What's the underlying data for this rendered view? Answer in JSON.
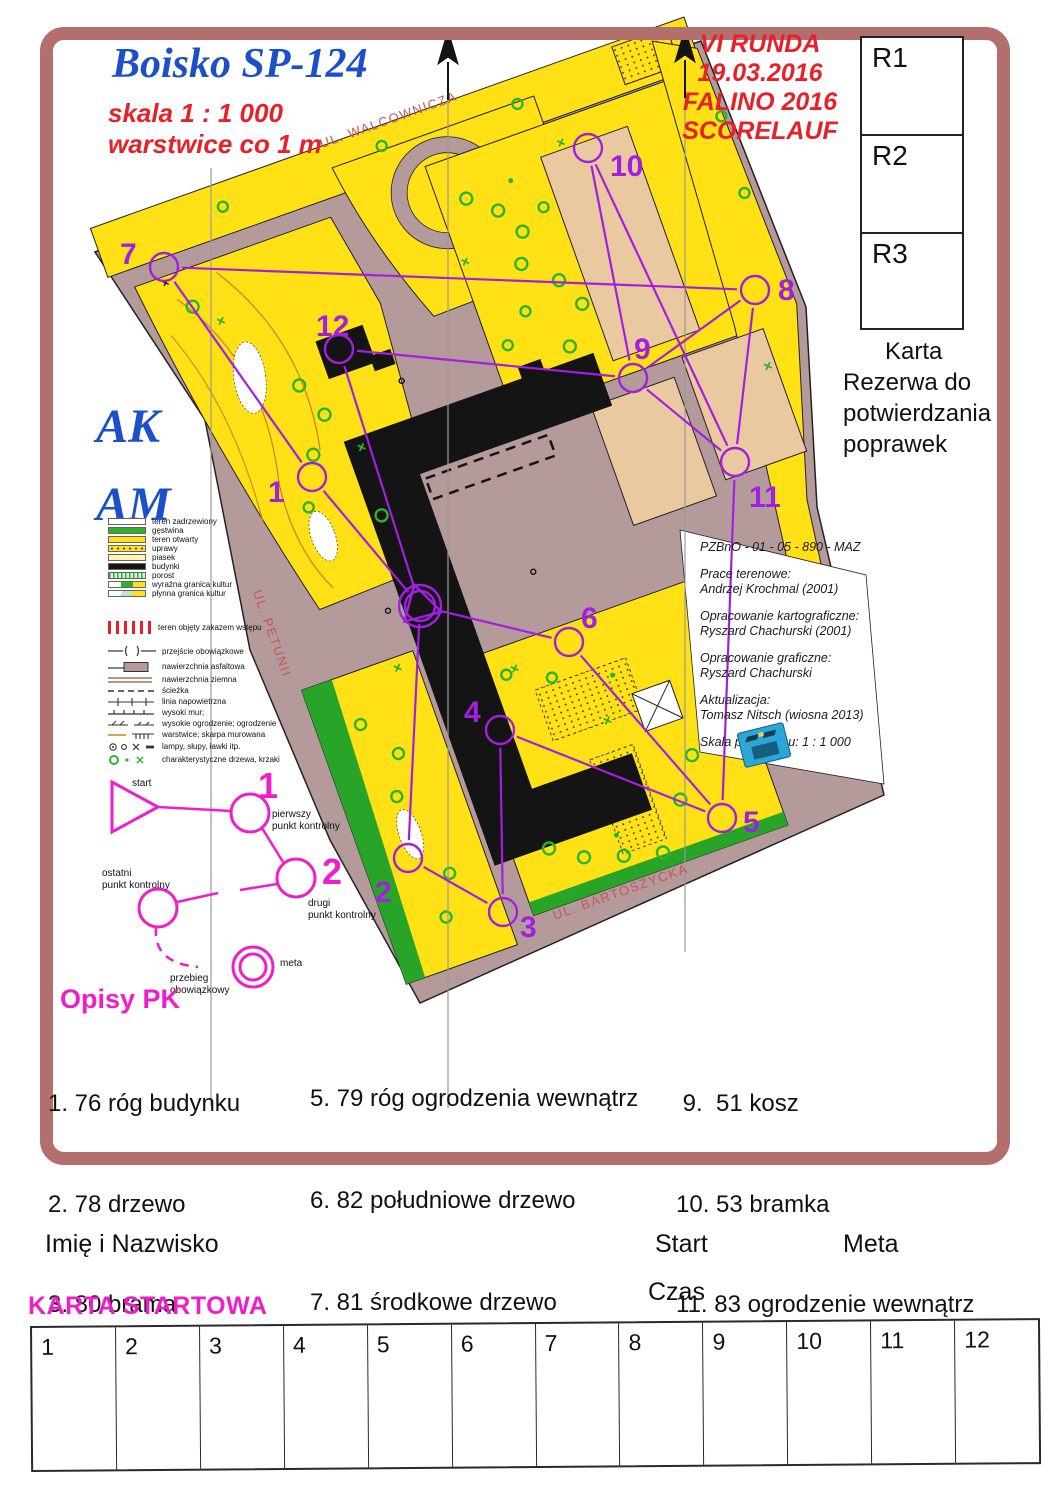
{
  "page": {
    "title": "Boisko SP-124",
    "scale_line1": "skala 1 : 1 000",
    "scale_line2": "warstwice co 1 m"
  },
  "event": {
    "lines": [
      "VI RUNDA",
      "19.03.2016",
      "FALINO 2016",
      "SCORELAUF"
    ]
  },
  "reserve_boxes": [
    "R1",
    "R2",
    "R3"
  ],
  "reserve_note": {
    "lines": [
      "Karta",
      "Rezerwa do",
      "potwierdzania",
      "poprawek"
    ]
  },
  "class_labels": [
    "AK",
    "AM"
  ],
  "legend": {
    "area_items": [
      "teren zadrzewiony",
      "gęstwina",
      "teren otwarty",
      "uprawy",
      "piasek",
      "budynki",
      "porost",
      "wyraźna granica kultur",
      "płynna granica kultur"
    ],
    "forbidden_label": "teren objęty zakazem wstępu",
    "line_items": [
      "przejście obowiązkowe",
      "nawierzchnia asfaltowa",
      "nawierzchnia ziemna",
      "ścieżka",
      "linia napowietrzna",
      "wysoki mur;",
      "wysokie ogrodzenie; ogrodzenie",
      "warstwice; skarpa murowana",
      "lampy, słupy, ławki itp.",
      "charakterystyczne drzewa, krzaki"
    ]
  },
  "course_diagram": {
    "start_label": "start",
    "num1": "1",
    "num2": "2",
    "first": [
      "pierwszy",
      "punkt kontrolny"
    ],
    "second": [
      "drugi",
      "punkt kontrolny"
    ],
    "last": [
      "ostatni",
      "punkt kontrolny"
    ],
    "route": [
      "przebieg",
      "obowiązkowy"
    ],
    "finish_label": "meta"
  },
  "credits": {
    "id_line": "PZBnO - 01 - 05 - 890 - MAZ",
    "groups": [
      {
        "l1": "Prace terenowe:",
        "l2": "Andrzej Krochmal (2001)"
      },
      {
        "l1": "Opracowanie kartograficzne:",
        "l2": "Ryszard Chachurski (2001)"
      },
      {
        "l1": "Opracowanie graficzne:",
        "l2": "Ryszard Chachurski"
      },
      {
        "l1": "Aktualizacja:",
        "l2": "Tomasz Nitsch (wiosna 2013)"
      }
    ],
    "scale_line": "Skala pierworysu: 1 : 1 000"
  },
  "map": {
    "streets": [
      {
        "name": "UL. WALCOWNICZA",
        "x": 390,
        "y": 124,
        "angle": -19.6
      },
      {
        "name": "UL. PETUNII",
        "x": 268,
        "y": 600,
        "angle": 70.5
      },
      {
        "name": "UL. BARTOSZYCKA",
        "x": 622,
        "y": 896,
        "angle": -19.6
      }
    ],
    "controls": [
      {
        "n": "1",
        "x": 312,
        "y": 477,
        "lx": 268,
        "ly": 502
      },
      {
        "n": "2",
        "x": 408,
        "y": 858,
        "lx": 375,
        "ly": 902
      },
      {
        "n": "3",
        "x": 503,
        "y": 912,
        "lx": 520,
        "ly": 937
      },
      {
        "n": "4",
        "x": 500,
        "y": 730,
        "lx": 464,
        "ly": 722
      },
      {
        "n": "5",
        "x": 722,
        "y": 818,
        "lx": 743,
        "ly": 832
      },
      {
        "n": "6",
        "x": 569,
        "y": 642,
        "lx": 581,
        "ly": 628
      },
      {
        "n": "7",
        "x": 164,
        "y": 267,
        "lx": 120,
        "ly": 264
      },
      {
        "n": "8",
        "x": 755,
        "y": 290,
        "lx": 778,
        "ly": 300
      },
      {
        "n": "9",
        "x": 633,
        "y": 378,
        "lx": 634,
        "ly": 359
      },
      {
        "n": "10",
        "x": 588,
        "y": 148,
        "lx": 610,
        "ly": 176
      },
      {
        "n": "11",
        "x": 735,
        "y": 462,
        "lx": 749,
        "ly": 507
      },
      {
        "n": "12",
        "x": 339,
        "y": 349,
        "lx": 316,
        "ly": 336
      }
    ],
    "start": {
      "x": 420,
      "y": 606
    },
    "lines": [
      [
        "7",
        "8"
      ],
      [
        "7",
        "1"
      ],
      [
        "1",
        "S"
      ],
      [
        "12",
        "S"
      ],
      [
        "12",
        "9"
      ],
      [
        "10",
        "9"
      ],
      [
        "10",
        "11"
      ],
      [
        "8",
        "9"
      ],
      [
        "8",
        "11"
      ],
      [
        "9",
        "11"
      ],
      [
        "11",
        "5"
      ],
      [
        "S",
        "6"
      ],
      [
        "6",
        "5"
      ],
      [
        "5",
        "4"
      ],
      [
        "4",
        "3"
      ],
      [
        "3",
        "2"
      ],
      [
        "2",
        "S"
      ]
    ]
  },
  "opisy": {
    "heading": "Opisy PK",
    "col1": [
      "1. 76 róg budynku",
      "2. 78 drzewo",
      "3. 80 brama",
      "4. 58 drzewo"
    ],
    "col2": [
      "5. 79 róg ogrodzenia wewnątrz",
      "6. 82 południowe drzewo",
      "7. 81 środkowe drzewo",
      "8. 77 ogrodzenie"
    ],
    "col3": [
      " 9.  51 kosz",
      "10. 53 bramka",
      "11. 83 ogrodzenie wewnątrz",
      "12. 84 róg budynku"
    ]
  },
  "form": {
    "name_label": "Imię i Nazwisko",
    "start_label": "Start",
    "meta_label": "Meta",
    "card_label": "KARTA STARTOWA",
    "time_label": "Czas",
    "cells": [
      "1",
      "2",
      "3",
      "4",
      "5",
      "6",
      "7",
      "8",
      "9",
      "10",
      "11",
      "12"
    ]
  },
  "colors": {
    "overprint": "#a21fe0",
    "magenta": "#f01ec8",
    "red": "#e62129",
    "blue": "#1d50c8",
    "border": "#b26f6d",
    "road": "#b59a9b",
    "open_terrain": "#ffe115",
    "field": "#eac9a0",
    "green": "#2db32d"
  }
}
